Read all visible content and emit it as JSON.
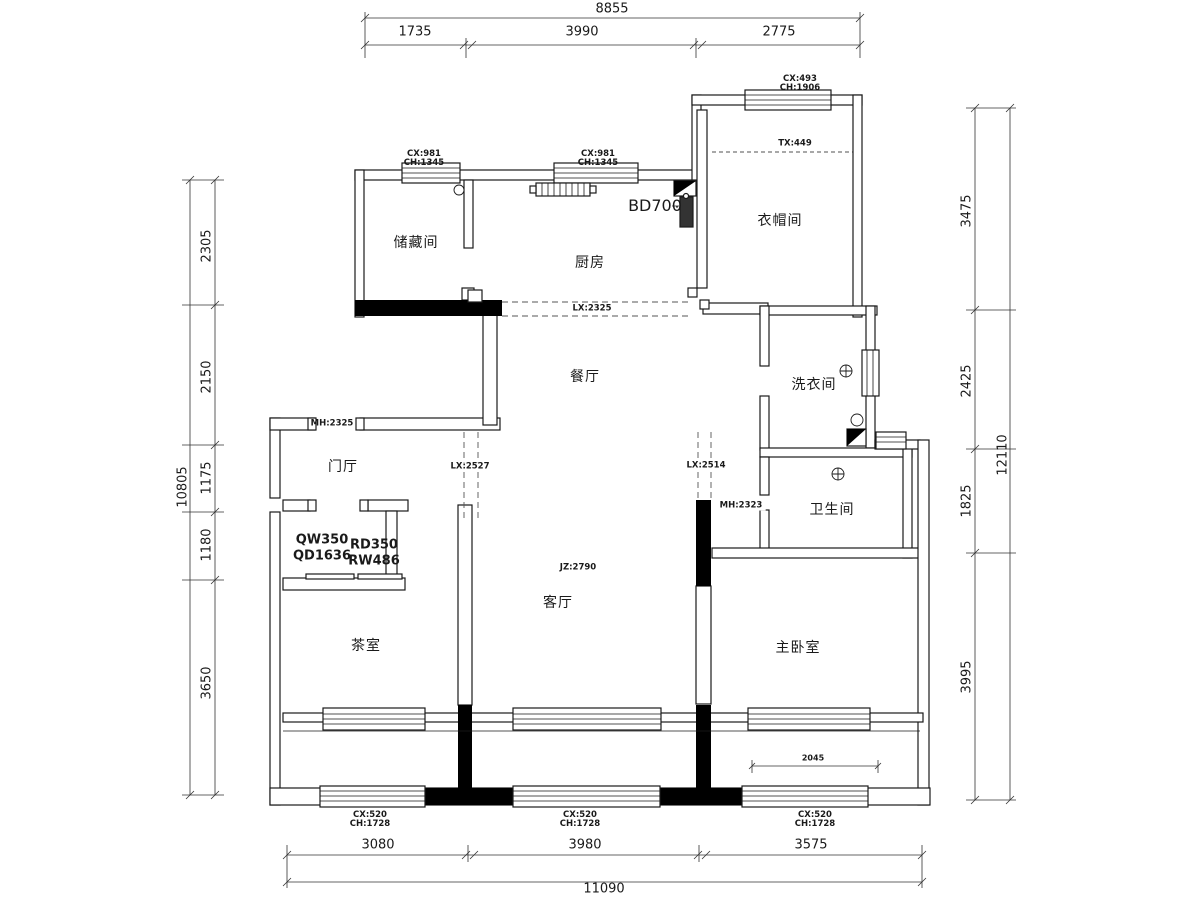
{
  "rooms": {
    "storage": "储藏间",
    "kitchen": "厨房",
    "cloakroom": "衣帽间",
    "laundry": "洗衣间",
    "bathroom": "卫生间",
    "foyer": "门厅",
    "dining": "餐厅",
    "living": "客厅",
    "tea": "茶室",
    "master": "主卧室"
  },
  "dimensions": {
    "top_total": "8855",
    "top_seg_1": "1735",
    "top_seg_2": "3990",
    "top_seg_3": "2775",
    "bottom_total": "11090",
    "bottom_seg_1": "3080",
    "bottom_seg_2": "3980",
    "bottom_seg_3": "3575",
    "left_total": "10805",
    "left_seg_1": "2305",
    "left_seg_2": "2150",
    "left_seg_3": "1175",
    "left_seg_4": "1180",
    "left_seg_5": "3650",
    "right_total": "12110",
    "right_seg_1": "3475",
    "right_seg_2": "2425",
    "right_seg_3": "1825",
    "right_seg_4": "3995",
    "balcony_width": "2045"
  },
  "annotations": {
    "window_storage": "CX:981\nCH:1345",
    "window_kitchen": "CX:981\nCH:1345",
    "window_cloakroom": "CX:493\nCH:1906",
    "tx_cloakroom": "TX:449",
    "bd_heater": "BD700",
    "lx_kitchen_opening": "LX:2325",
    "lx_left_opening": "LX:2527",
    "lx_right_opening": "LX:2514",
    "mh_entry_door": "MH:2325",
    "mh_bath_door": "MH:2323",
    "jz_living": "JZ:2790",
    "qw_codes": "QW350\nQD1636",
    "rd_codes": "RD350\nRW486",
    "window_bottom_1": "CX:520\nCH:1728",
    "window_bottom_2": "CX:520\nCH:1728",
    "window_bottom_3": "CX:520\nCH:1728"
  },
  "colors": {
    "line": "#1a1a1a",
    "wall": "#000000",
    "background": "#ffffff"
  }
}
